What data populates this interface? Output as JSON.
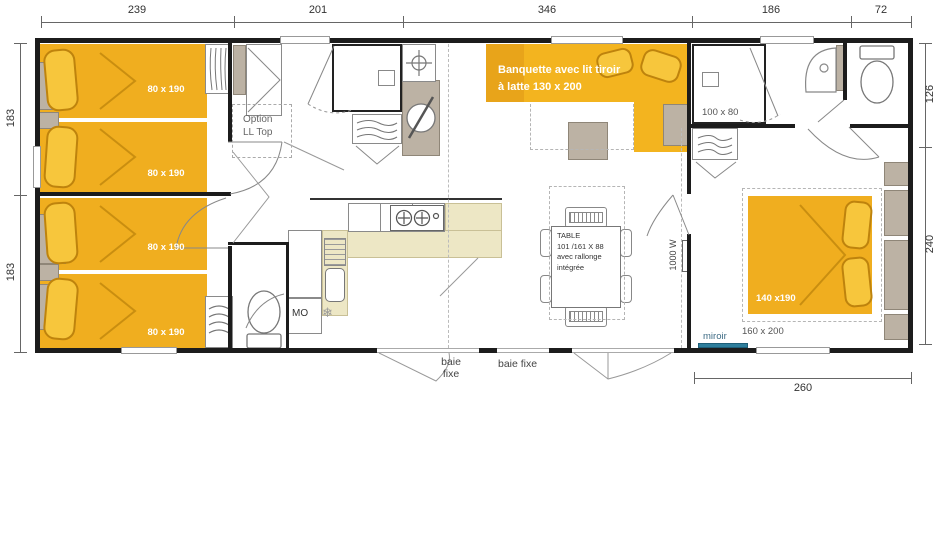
{
  "title": "mobile-home floor plan",
  "colors": {
    "furniture_yellow": "#F0AE1F",
    "banquette_yellow": "#F3B41F",
    "pillow_yellow": "#F7C63C",
    "accent_dark_yellow": "#C98E10",
    "wood_tan": "#BCB2A4",
    "kitchen_cream": "#EDE7C5",
    "wall_black": "#1C1C1C",
    "mirror_teal": "#2E7E9C"
  },
  "dimensions": {
    "top": [
      "239",
      "201",
      "346",
      "186",
      "72"
    ],
    "left": [
      "183",
      "183"
    ],
    "right": [
      "126",
      "240"
    ],
    "bottom": "260"
  },
  "bedroom_left": {
    "beds": [
      {
        "size": "80 x 190"
      },
      {
        "size": "80 x 190"
      },
      {
        "size": "80 x 190"
      },
      {
        "size": "80 x 190"
      }
    ],
    "option_lines": [
      "Option",
      "LL Top"
    ]
  },
  "bathroom_right": {
    "shower_size": "100 x 80"
  },
  "kitchen": {
    "microwave": "MO"
  },
  "icons": {
    "freezer": "❄"
  },
  "living": {
    "banquette_lines": [
      "Banquette avec lit tiroir",
      "à latte 130 x 200"
    ],
    "table_lines": [
      "TABLE",
      "101 /161 X 88",
      "avec rallonge",
      "intégrée"
    ],
    "heater": "1000 W"
  },
  "master_bedroom": {
    "bed_size": "140 x190",
    "footprint": "160 x 200",
    "mirror": "miroir"
  },
  "openings": {
    "bay_fixed_left_lines": [
      "baie",
      "fixe"
    ],
    "bay_fixed_center": "baie fixe"
  }
}
